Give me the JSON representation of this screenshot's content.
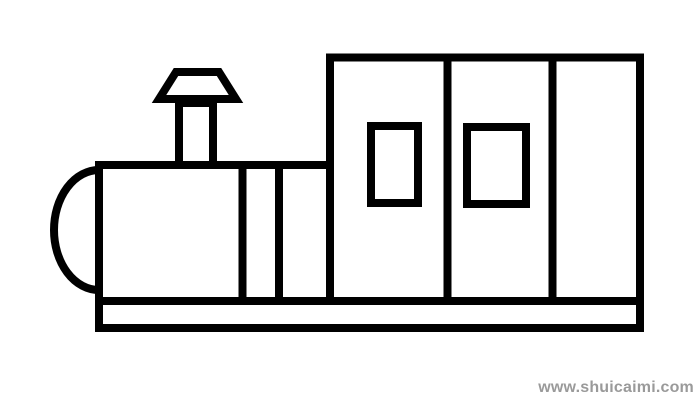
{
  "page": {
    "background_color": "#ffffff"
  },
  "drawing": {
    "subject": "train-line-drawing",
    "stroke_color": "#000000",
    "fill_color": "#ffffff",
    "stroke_width": 8,
    "parts": [
      "front-arc",
      "boiler",
      "boiler-stripe-1",
      "boiler-stripe-2",
      "chimney-stack",
      "chimney-cap",
      "cab",
      "cab-divider-1",
      "cab-divider-2",
      "cab-window-1",
      "cab-window-2",
      "base-platform"
    ]
  },
  "watermark": {
    "text": "www.shuicaimi.com",
    "color": "#9a9a9a"
  }
}
